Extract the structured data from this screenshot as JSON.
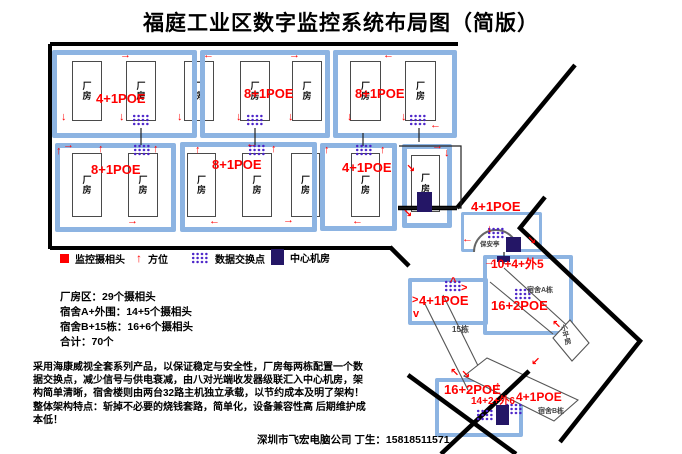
{
  "title": "福庭工业区数字监控系统布局图（简版）",
  "room_label": "厂房",
  "colors": {
    "block_border": "#8db4e2",
    "red": "#ff0000",
    "cluster": "#4a23c8",
    "navy": "#241666",
    "gray_label": "#444444"
  },
  "legend": [
    {
      "icon": "camera",
      "label": "监控摄相头",
      "x": 60,
      "y": 249
    },
    {
      "icon": "direction",
      "label": "方位",
      "x": 136,
      "y": 249
    },
    {
      "icon": "switch",
      "label": "数据交换点",
      "x": 191,
      "y": 249
    },
    {
      "icon": "machine-room",
      "label": "中心机房",
      "x": 271,
      "y": 248
    }
  ],
  "stats_lines": [
    "厂房区：29个摄相头",
    "宿舍A+外围：14+5个摄相头",
    "宿舍B+15栋：16+6个摄相头",
    "合计：70个"
  ],
  "description": "采用海康威视全套系列产品，以保证稳定与安全性，厂房每两栋配置一个数据交换点，减少信号与供电衰减，由八对光端收发器级联汇入中心机房，架构简单清晰，宿舍楼则由两台32路主机独立承载，以节约成本及明了架构！ 整体架构特点：斩掉不必要的烧钱套路，简单化，设备兼容性高 后期维护成本低！",
  "footer": "深圳市飞宏电脑公司 丁生：15818511571",
  "diagram": {
    "blocks": [
      {
        "x": 52,
        "y": 50,
        "w": 145,
        "h": 88,
        "bw": 5
      },
      {
        "x": 200,
        "y": 50,
        "w": 130,
        "h": 88,
        "bw": 5
      },
      {
        "x": 333,
        "y": 50,
        "w": 124,
        "h": 88,
        "bw": 5
      },
      {
        "x": 55,
        "y": 143,
        "w": 121,
        "h": 89,
        "bw": 5
      },
      {
        "x": 180,
        "y": 142,
        "w": 137,
        "h": 90,
        "bw": 5
      },
      {
        "x": 320,
        "y": 143,
        "w": 77,
        "h": 88,
        "bw": 5
      },
      {
        "x": 402,
        "y": 144,
        "w": 50,
        "h": 84,
        "bw": 5
      },
      {
        "x": 461,
        "y": 212,
        "w": 81,
        "h": 40,
        "bw": 3
      },
      {
        "x": 483,
        "y": 255,
        "w": 90,
        "h": 80,
        "bw": 4
      },
      {
        "x": 408,
        "y": 278,
        "w": 80,
        "h": 47,
        "bw": 4
      },
      {
        "x": 435,
        "y": 378,
        "w": 88,
        "h": 59,
        "bw": 4
      }
    ],
    "rooms": [
      {
        "x": 72,
        "y": 61,
        "w": 30,
        "h": 60
      },
      {
        "x": 126,
        "y": 61,
        "w": 30,
        "h": 60
      },
      {
        "x": 184,
        "y": 61,
        "w": 30,
        "h": 60
      },
      {
        "x": 240,
        "y": 61,
        "w": 30,
        "h": 60
      },
      {
        "x": 292,
        "y": 61,
        "w": 30,
        "h": 60
      },
      {
        "x": 350,
        "y": 61,
        "w": 31,
        "h": 60
      },
      {
        "x": 405,
        "y": 61,
        "w": 31,
        "h": 60
      },
      {
        "x": 72,
        "y": 153,
        "w": 30,
        "h": 64
      },
      {
        "x": 128,
        "y": 153,
        "w": 30,
        "h": 64
      },
      {
        "x": 187,
        "y": 153,
        "w": 29,
        "h": 64
      },
      {
        "x": 242,
        "y": 153,
        "w": 30,
        "h": 64
      },
      {
        "x": 291,
        "y": 153,
        "w": 29,
        "h": 64
      },
      {
        "x": 351,
        "y": 153,
        "w": 29,
        "h": 64
      },
      {
        "x": 411,
        "y": 155,
        "w": 29,
        "h": 57
      }
    ],
    "clusters": [
      {
        "x": 132,
        "y": 114
      },
      {
        "x": 246,
        "y": 114
      },
      {
        "x": 409,
        "y": 114
      },
      {
        "x": 133,
        "y": 144
      },
      {
        "x": 248,
        "y": 144
      },
      {
        "x": 355,
        "y": 144
      },
      {
        "x": 487,
        "y": 227
      },
      {
        "x": 514,
        "y": 288
      },
      {
        "x": 444,
        "y": 280
      },
      {
        "x": 476,
        "y": 409
      },
      {
        "x": 505,
        "y": 403
      }
    ],
    "navy_squares": [
      {
        "x": 417,
        "y": 192,
        "w": 15,
        "h": 20
      },
      {
        "x": 506,
        "y": 237,
        "w": 15,
        "h": 15
      },
      {
        "x": 497,
        "y": 256,
        "w": 13,
        "h": 6
      },
      {
        "x": 496,
        "y": 405,
        "w": 13,
        "h": 20
      }
    ],
    "arrows": [
      {
        "g": "→",
        "x": 120,
        "y": 50
      },
      {
        "g": "↓",
        "x": 61,
        "y": 112
      },
      {
        "g": "↓",
        "x": 119,
        "y": 112
      },
      {
        "g": "↓",
        "x": 177,
        "y": 112
      },
      {
        "g": "←",
        "x": 203,
        "y": 50
      },
      {
        "g": "→",
        "x": 289,
        "y": 50
      },
      {
        "g": "↓",
        "x": 236,
        "y": 112
      },
      {
        "g": "↓",
        "x": 288,
        "y": 112
      },
      {
        "g": "←",
        "x": 383,
        "y": 50
      },
      {
        "g": "↓",
        "x": 347,
        "y": 112
      },
      {
        "g": "↓",
        "x": 401,
        "y": 112
      },
      {
        "g": "←",
        "x": 430,
        "y": 120
      },
      {
        "g": "↑",
        "x": 56,
        "y": 146
      },
      {
        "g": "→",
        "x": 63,
        "y": 140
      },
      {
        "g": "↑",
        "x": 98,
        "y": 144
      },
      {
        "g": "↑",
        "x": 153,
        "y": 144
      },
      {
        "g": "→",
        "x": 127,
        "y": 216
      },
      {
        "g": "↑",
        "x": 195,
        "y": 145
      },
      {
        "g": "←",
        "x": 246,
        "y": 139
      },
      {
        "g": "↑",
        "x": 271,
        "y": 144
      },
      {
        "g": "←",
        "x": 209,
        "y": 216
      },
      {
        "g": "→",
        "x": 283,
        "y": 215
      },
      {
        "g": "↑",
        "x": 324,
        "y": 145
      },
      {
        "g": "↑",
        "x": 380,
        "y": 145
      },
      {
        "g": "←",
        "x": 352,
        "y": 216
      },
      {
        "g": "→",
        "x": 432,
        "y": 141
      },
      {
        "g": "↓",
        "x": 444,
        "y": 148
      },
      {
        "g": "↘",
        "x": 406,
        "y": 164
      },
      {
        "g": "↘",
        "x": 403,
        "y": 209
      },
      {
        "g": "←",
        "x": 462,
        "y": 234
      },
      {
        "g": "↘",
        "x": 527,
        "y": 236
      },
      {
        "g": "↓",
        "x": 487,
        "y": 224
      },
      {
        "g": "→",
        "x": 484,
        "y": 257
      },
      {
        "g": "↖",
        "x": 552,
        "y": 320
      },
      {
        "g": "^",
        "x": 450,
        "y": 277
      },
      {
        "g": ">",
        "x": 461,
        "y": 283
      },
      {
        "g": ">",
        "x": 412,
        "y": 295
      },
      {
        "g": "v",
        "x": 413,
        "y": 309
      },
      {
        "g": "↖",
        "x": 450,
        "y": 368
      },
      {
        "g": "↘",
        "x": 461,
        "y": 370
      },
      {
        "g": "↑",
        "x": 495,
        "y": 381
      },
      {
        "g": "↙",
        "x": 531,
        "y": 357
      }
    ],
    "red_labels": [
      {
        "t": "4+1POE",
        "x": 96,
        "y": 92,
        "s": 13
      },
      {
        "t": "8+1POE",
        "x": 244,
        "y": 87,
        "s": 13
      },
      {
        "t": "8+1POE",
        "x": 355,
        "y": 87,
        "s": 13
      },
      {
        "t": "8+1POE",
        "x": 91,
        "y": 163,
        "s": 13
      },
      {
        "t": "8+1POE",
        "x": 212,
        "y": 158,
        "s": 13
      },
      {
        "t": "4+1POE",
        "x": 342,
        "y": 161,
        "s": 13
      },
      {
        "t": "4+1POE",
        "x": 471,
        "y": 200,
        "s": 13
      },
      {
        "t": "10+4+外5",
        "x": 491,
        "y": 258,
        "s": 12
      },
      {
        "t": "16+2POE",
        "x": 491,
        "y": 299,
        "s": 13
      },
      {
        "t": "4+1POE",
        "x": 419,
        "y": 294,
        "s": 13
      },
      {
        "t": "16+2POE",
        "x": 444,
        "y": 383,
        "s": 13
      },
      {
        "t": "14+2+外6",
        "x": 471,
        "y": 397,
        "s": 10
      },
      {
        "t": "4+1POE",
        "x": 516,
        "y": 391,
        "s": 12
      }
    ],
    "gray_labels": [
      {
        "t": "保安亭",
        "x": 480,
        "y": 242,
        "s": 6.5
      },
      {
        "t": "宿舍A栋",
        "x": 527,
        "y": 287,
        "s": 7
      },
      {
        "t": "15栋",
        "x": 452,
        "y": 326,
        "s": 8
      },
      {
        "t": "宿舍B栋",
        "x": 538,
        "y": 408,
        "s": 7
      },
      {
        "t": "小平房",
        "x": 562,
        "y": 324,
        "s": 7,
        "vertical": true,
        "rotate": -15
      }
    ],
    "roads_thick": [
      "M575,65 L457,208",
      "M398,208 L457,208",
      "M545,197 L520,228 L640,341 L560,442",
      "M390,247 L409,266",
      "M408,375 L516,454",
      "M529,371 L441,454"
    ],
    "border_paths": [
      "M50,44 L458,44",
      "M50,44 L50,249",
      "M50,248 L391,248"
    ],
    "thin_black": [
      "M399,146 L461,146 L461,208 L399,208",
      "M141,128 L141,145",
      "M255,128 L255,145",
      "M363,133 L363,146",
      "M419,128 L419,142",
      "M504,252 L504,264"
    ],
    "thin_gray": [
      "M490,282 L553,334",
      "M504,268 L572,330",
      "M443,295 L490,390",
      "M424,302 L468,390",
      "M464,376 L487,358 L578,400 L554,421 Z",
      "M553,338 L570,320 L589,343 L572,361 Z"
    ],
    "dome": "M474,252 A22,22 0 0 1 518,252"
  }
}
